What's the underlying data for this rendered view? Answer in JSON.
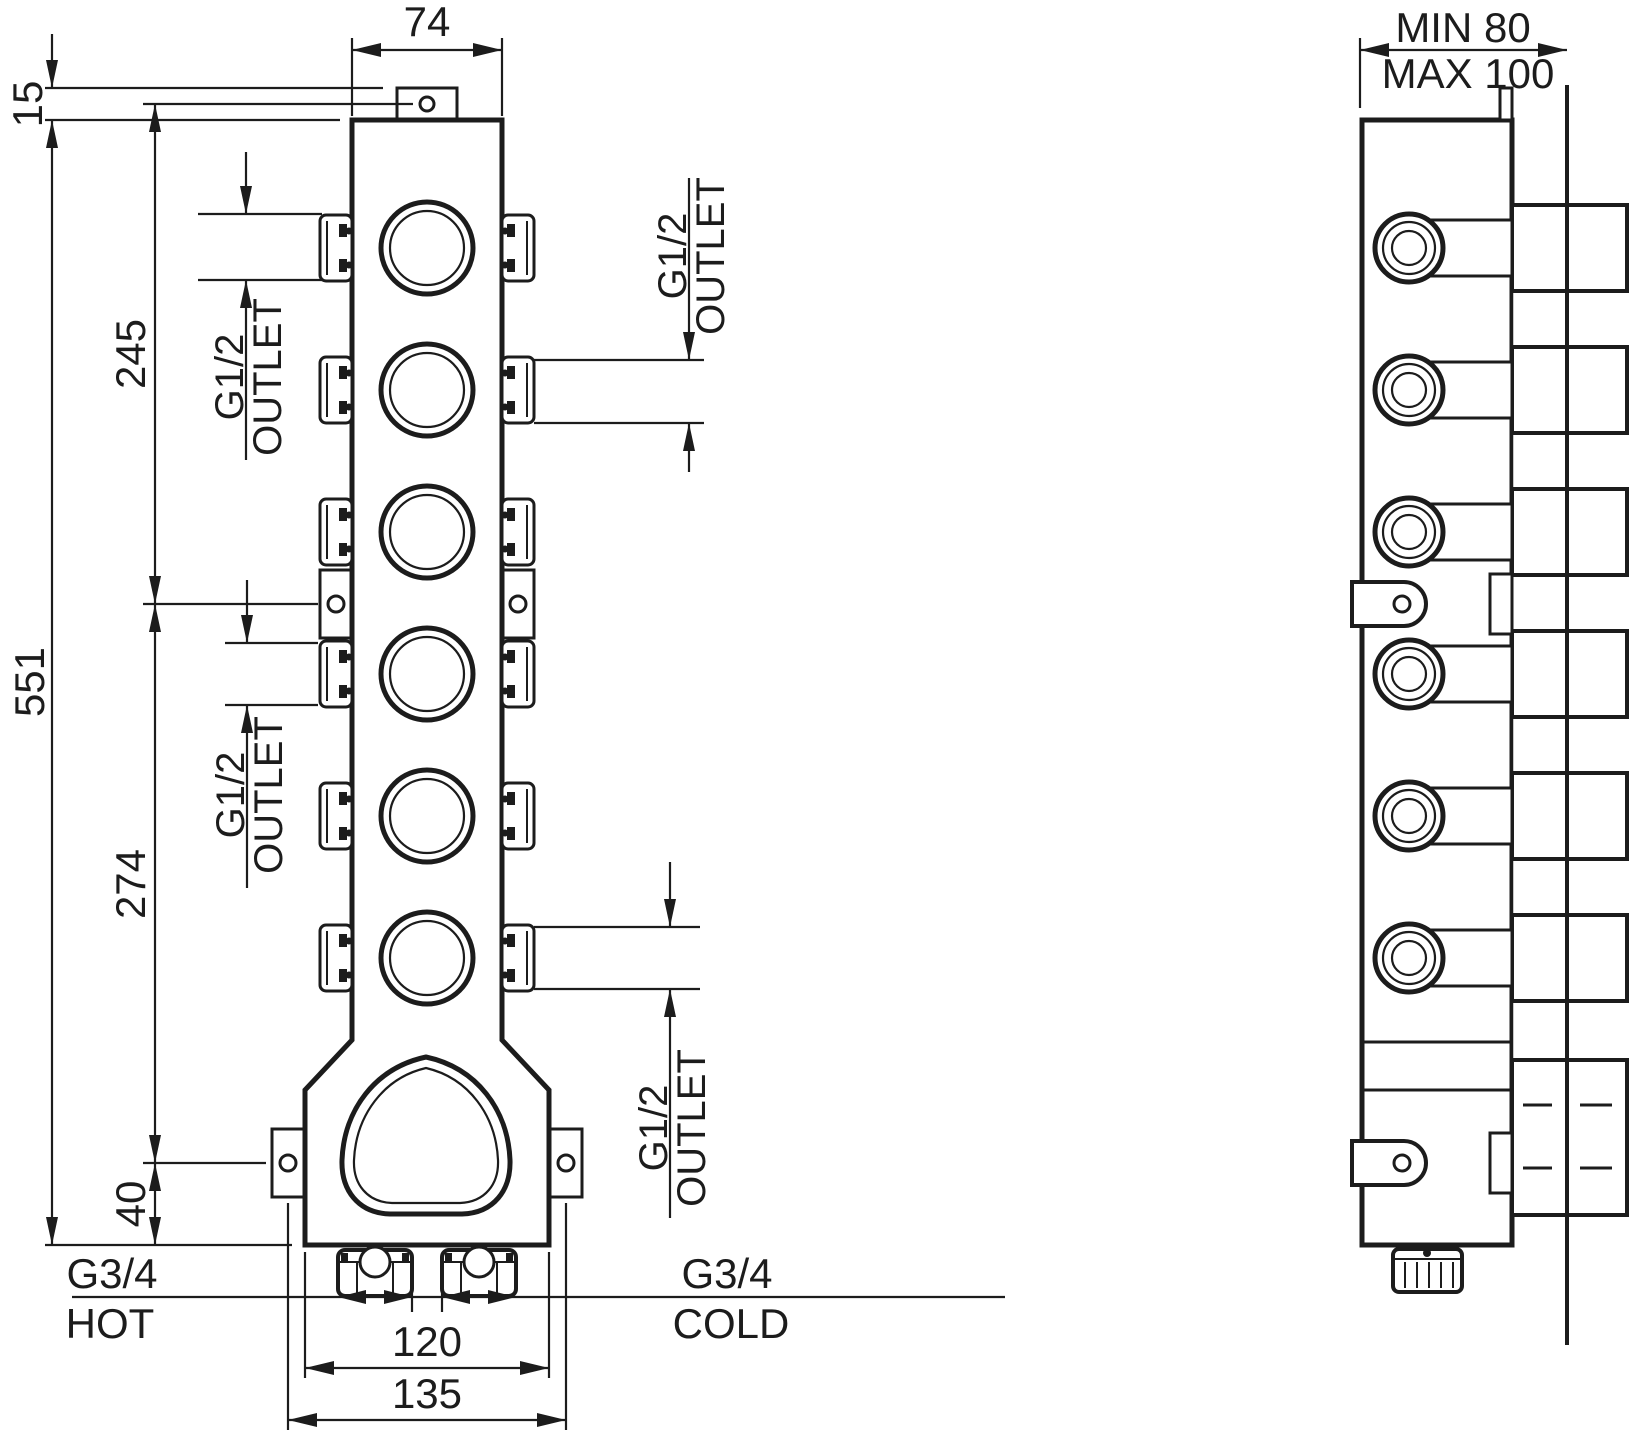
{
  "drawing": {
    "kind": "valve rough-in installation drawing",
    "units": "mm",
    "front": {
      "dims": {
        "width": "74",
        "tab_offset": "15",
        "upper_span": "245",
        "total_height": "551",
        "mid_span": "274",
        "bottom_offset": "40",
        "inlet_span": "120",
        "mount_span": "135"
      },
      "ports": {
        "thread": "G1/2",
        "word": "OUTLET"
      },
      "inlets": {
        "thread": "G3/4",
        "hot": "HOT",
        "cold": "COLD"
      }
    },
    "side": {
      "dims": {
        "depth_min": "MIN 80",
        "depth_max": "MAX 100"
      }
    }
  }
}
